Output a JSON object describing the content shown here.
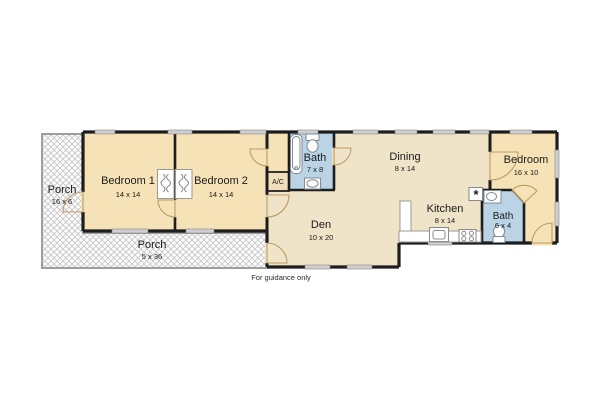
{
  "title": "Floor plan",
  "footer": {
    "disclaimer": "For guidance only"
  },
  "symbols": {
    "water_heater": "*"
  },
  "colors": {
    "wall": "#1d1d1d",
    "bedroom_fill": "#f5e2b6",
    "living_fill": "#efe3c8",
    "bath_fill": "#bad4e6",
    "window_fill": "#cfcfcf",
    "porch_border": "#9e9e9e",
    "door_stroke": "#bd9b66"
  },
  "rooms": [
    {
      "id": "porch-left",
      "name": "Porch",
      "dims": "16 x 6"
    },
    {
      "id": "bedroom-1",
      "name": "Bedroom 1",
      "dims": "14 x 14"
    },
    {
      "id": "bedroom-2",
      "name": "Bedroom 2",
      "dims": "14 x 14"
    },
    {
      "id": "bath-main",
      "name": "Bath",
      "dims": "7 x 8"
    },
    {
      "id": "ac-closet",
      "name": "A/C",
      "dims": ""
    },
    {
      "id": "dining",
      "name": "Dining",
      "dims": "8 x 14"
    },
    {
      "id": "den",
      "name": "Den",
      "dims": "10 x 20"
    },
    {
      "id": "kitchen",
      "name": "Kitchen",
      "dims": "8 x 14"
    },
    {
      "id": "bath-small",
      "name": "Bath",
      "dims": "6 x 4"
    },
    {
      "id": "bedroom-3",
      "name": "Bedroom",
      "dims": "16 x 10"
    },
    {
      "id": "porch-bottom",
      "name": "Porch",
      "dims": "5 x 36"
    }
  ]
}
